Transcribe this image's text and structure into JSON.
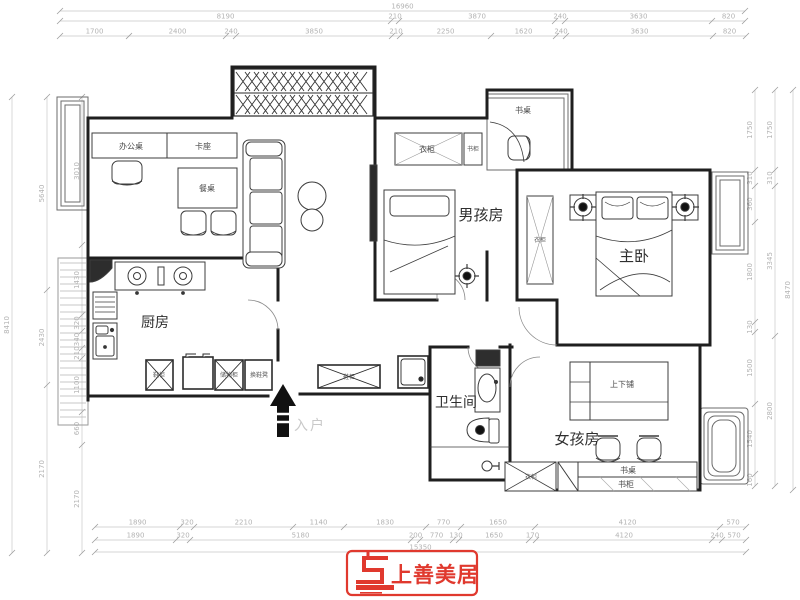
{
  "rooms": {
    "kitchen": "厨房",
    "boy": "男孩房",
    "master": "主卧",
    "bathroom": "卫生间",
    "girl": "女孩房"
  },
  "entry_label": "入户",
  "furniture": {
    "office_desk": "办公桌",
    "booth": "卡座",
    "dining_table": "餐桌",
    "balcony_desk": "书桌",
    "boy_wardrobe": "衣柜",
    "boy_bookcase": "书柜",
    "master_wardrobe": "衣柜",
    "bunk_bed": "上下铺",
    "girl_desk": "书桌",
    "girl_bookcase": "书柜",
    "girl_wardrobe": "衣柜",
    "storage_cabinet": "储物柜",
    "shoe_bench": "换鞋凳",
    "hall_shoe_cabinet": "鞋柜",
    "entry_shoe_cabinet": "鞋柜"
  },
  "dimensions": {
    "top_overall": [
      "16960"
    ],
    "top_row2": [
      "8190",
      "210",
      "3870",
      "240",
      "3630",
      "820"
    ],
    "top_row3": [
      "1700",
      "2400",
      "240",
      "3850",
      "210",
      "2250",
      "1620",
      "240",
      "3630",
      "820"
    ],
    "bottom_row1": [
      "1890",
      "320",
      "2210",
      "1140",
      "1830",
      "770",
      "1650",
      "4120",
      "570"
    ],
    "bottom_row2": [
      "1890",
      "320",
      "5180",
      "200",
      "770",
      "130",
      "1650",
      "170",
      "4120",
      "240",
      "570"
    ],
    "bottom_overall": [
      "15350"
    ],
    "left_inner": [
      "3010",
      "1430",
      "320",
      "340",
      "210",
      "1100",
      "660",
      "2170"
    ],
    "left_mid": [
      "5640",
      "2430",
      "2170"
    ],
    "left_outer": [
      "8410"
    ],
    "right_inner": [
      "1750",
      "310",
      "360",
      "1800",
      "130",
      "1500",
      "1540",
      "160"
    ],
    "right_outer": [
      "1750",
      "310",
      "3345",
      "2800"
    ],
    "right_overall": [
      "8470"
    ]
  },
  "logo": {
    "name": "上善美居",
    "accent_color": "#e0392e"
  },
  "colors": {
    "wall": "#1f1f1f",
    "dim": "#b3b3b3",
    "furniture": "#3c3c3c"
  }
}
